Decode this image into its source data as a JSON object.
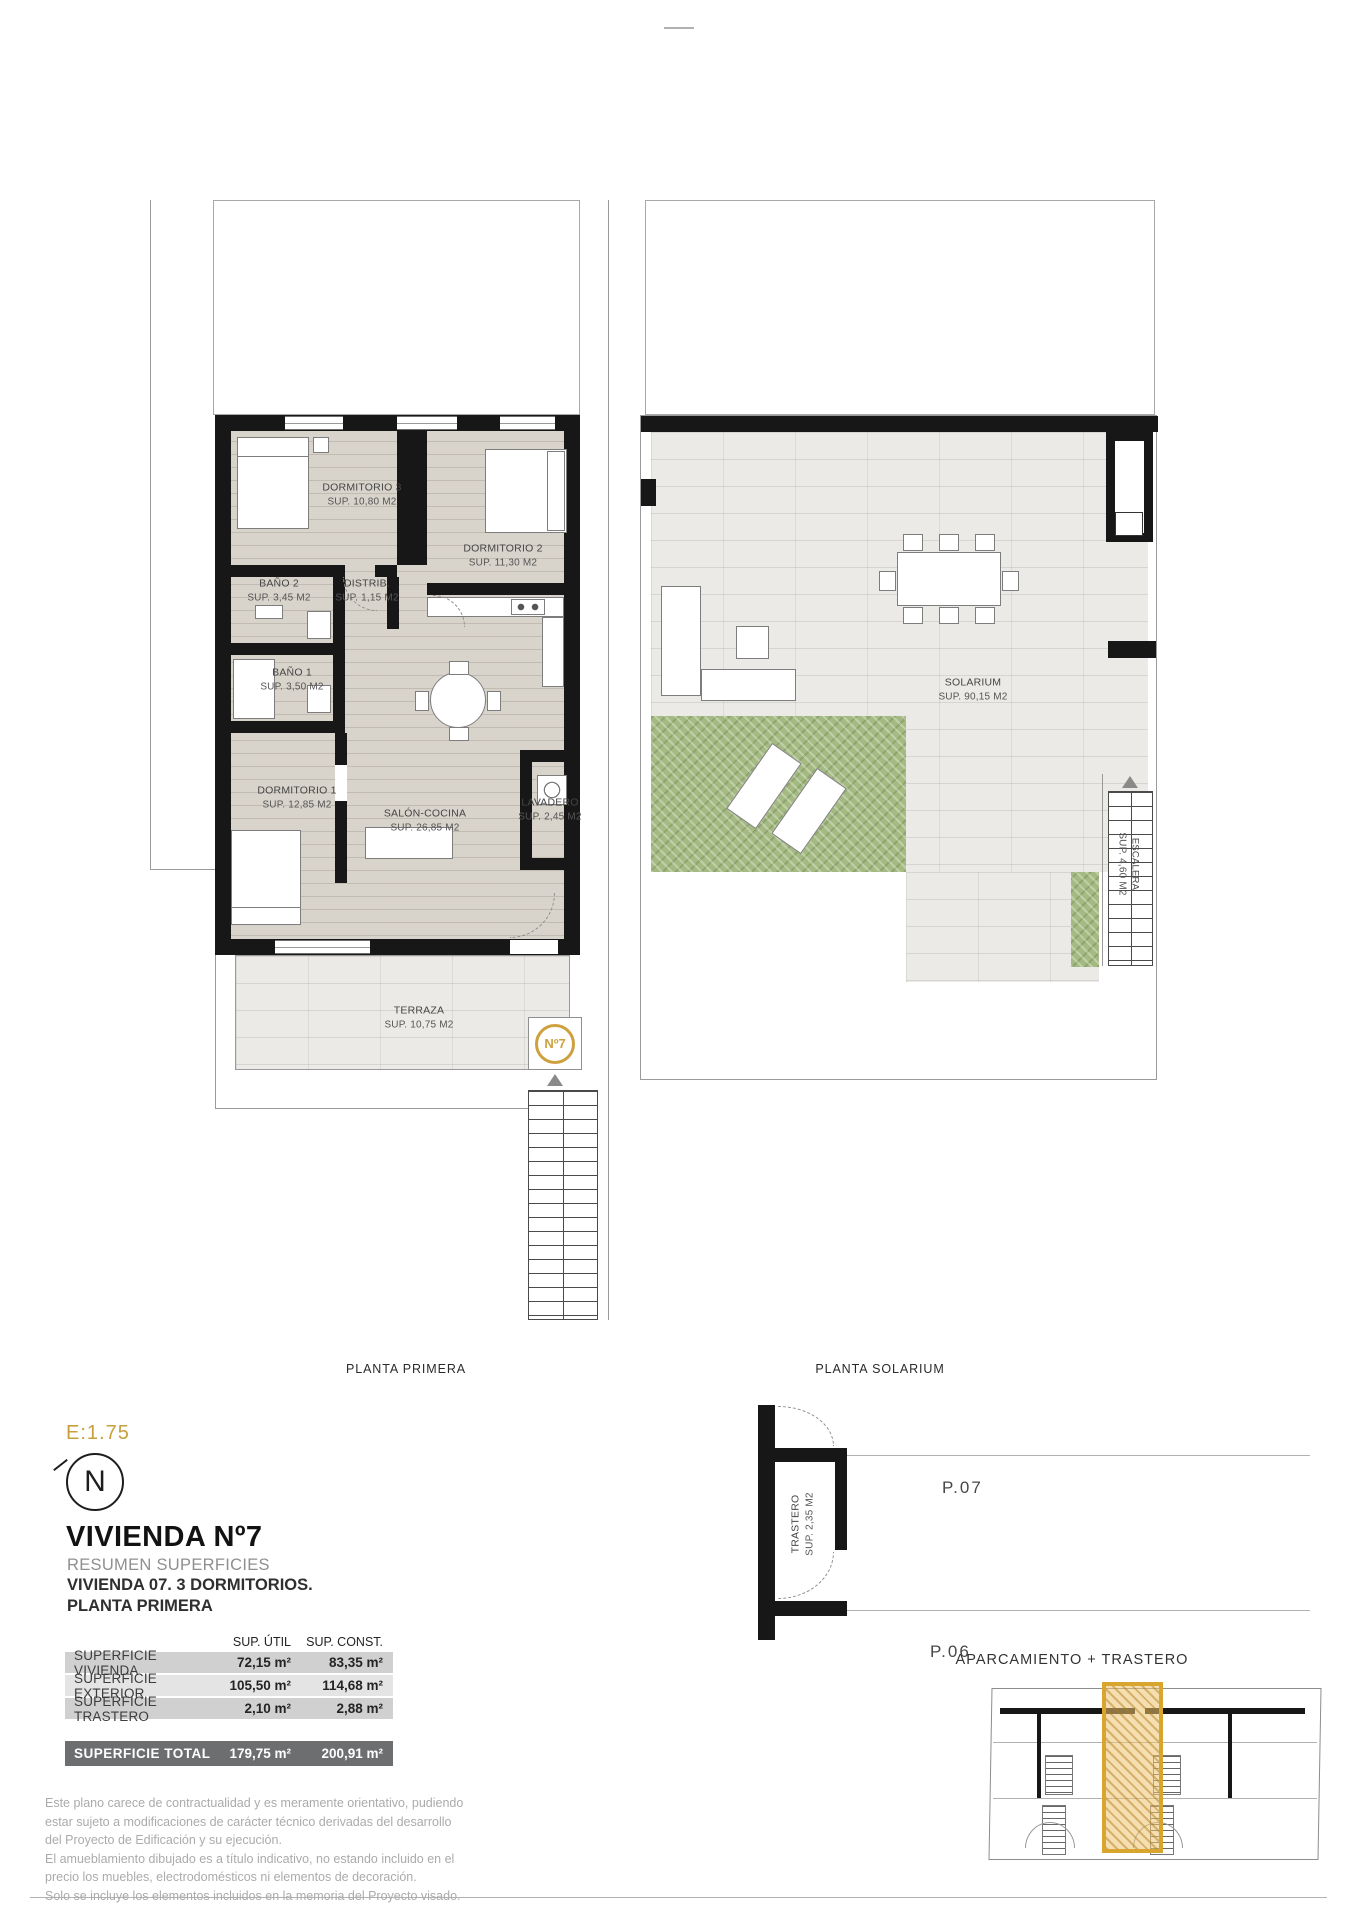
{
  "title_block": {
    "scale": "E:1.75",
    "north_letter": "N",
    "title": "VIVIENDA Nº7",
    "subtitle": "RESUMEN SUPERFICIES",
    "line2": "VIVIENDA 07. 3 DORMITORIOS.",
    "line3": "PLANTA PRIMERA"
  },
  "plans": {
    "primera": {
      "caption": "PLANTA PRIMERA",
      "badge": "Nº7",
      "rooms": [
        {
          "name": "DORMITORIO 3",
          "area": "SUP. 10,80 M2"
        },
        {
          "name": "DORMITORIO 2",
          "area": "SUP. 11,30 M2"
        },
        {
          "name": "BAÑO 2",
          "area": "SUP. 3,45 M2"
        },
        {
          "name": "DISTRIB.",
          "area": "SUP. 1,15 M2"
        },
        {
          "name": "BAÑO 1",
          "area": "SUP. 3,50 M2"
        },
        {
          "name": "DORMITORIO 1",
          "area": "SUP. 12,85 M2"
        },
        {
          "name": "SALÓN-COCINA",
          "area": "SUP. 26,85 M2"
        },
        {
          "name": "LAVADERO",
          "area": "SUP. 2,45 M2"
        },
        {
          "name": "TERRAZA",
          "area": "SUP. 10,75 M2"
        }
      ]
    },
    "solarium": {
      "caption": "PLANTA SOLARIUM",
      "rooms": [
        {
          "name": "SOLARIUM",
          "area": "SUP. 90,15 M2"
        },
        {
          "name": "ESCALERA",
          "area": "SUP. 4,60 M2"
        }
      ]
    },
    "aparcamiento": {
      "caption": "APARCAMIENTO + TRASTERO",
      "room_name": "TRASTERO",
      "room_area": "SUP. 2,35 M2",
      "parking": [
        "P.07",
        "P.06"
      ]
    }
  },
  "summary_table": {
    "col_headers": [
      "SUP. ÚTIL",
      "SUP. CONST."
    ],
    "rows": [
      {
        "label": "SUPERFICIE VIVIENDA",
        "util": "72,15 m²",
        "const": "83,35 m²"
      },
      {
        "label": "SUPERFICIE EXTERIOR",
        "util": "105,50 m²",
        "const": "114,68 m²"
      },
      {
        "label": "SUPERFICIE TRASTERO",
        "util": "2,10 m²",
        "const": "2,88 m²"
      }
    ],
    "total": {
      "label": "SUPERFICIE TOTAL",
      "util": "179,75 m²",
      "const": "200,91 m²"
    }
  },
  "disclaimer": {
    "lines": [
      "Este plano carece de contractualidad y es meramente orientativo, pudiendo",
      "estar sujeto a modificaciones de carácter técnico derivadas del desarrollo",
      "del Proyecto de Edificación y su ejecución.",
      "El amueblamiento dibujado es a título indicativo, no estando incluido en el",
      "precio los muebles, electrodomésticos ni elementos de decoración.",
      "Solo se incluye los elementos incluidos en la memoria del Proyecto visado."
    ]
  },
  "colors": {
    "accent_gold": "#D8A62E",
    "ring_gold": "#CDA13E",
    "wall_black": "#171717",
    "floor_plank": "#D8D4CC",
    "floor_tile": "#ECEAE7",
    "green_lawn": "#A4BA82",
    "table_row_gray": "#D0D0D0",
    "table_row_light": "#E4E4E4",
    "table_total_gray": "#6D6E70",
    "muted_text": "#ABABAB"
  }
}
